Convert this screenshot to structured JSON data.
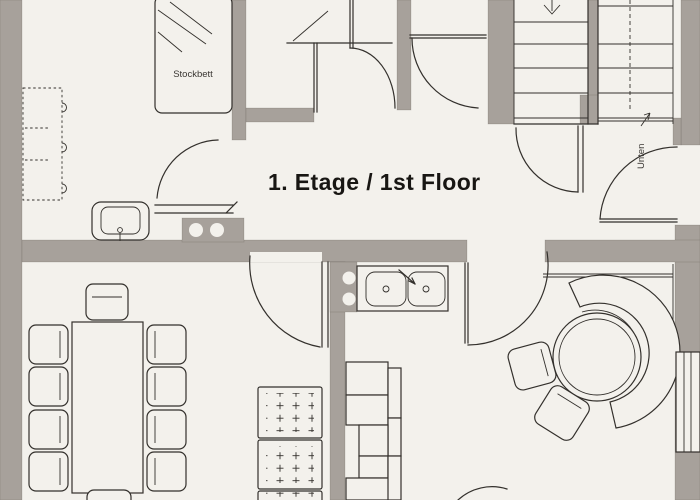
{
  "title": "1. Etage / 1st Floor",
  "labels": {
    "bunk_bed": "Stockbett",
    "stairs_down": "Unten"
  },
  "colors": {
    "paper": "#f3f1ec",
    "wall": "#a7a19b",
    "line": "#33302c",
    "title_text": "#181613"
  }
}
